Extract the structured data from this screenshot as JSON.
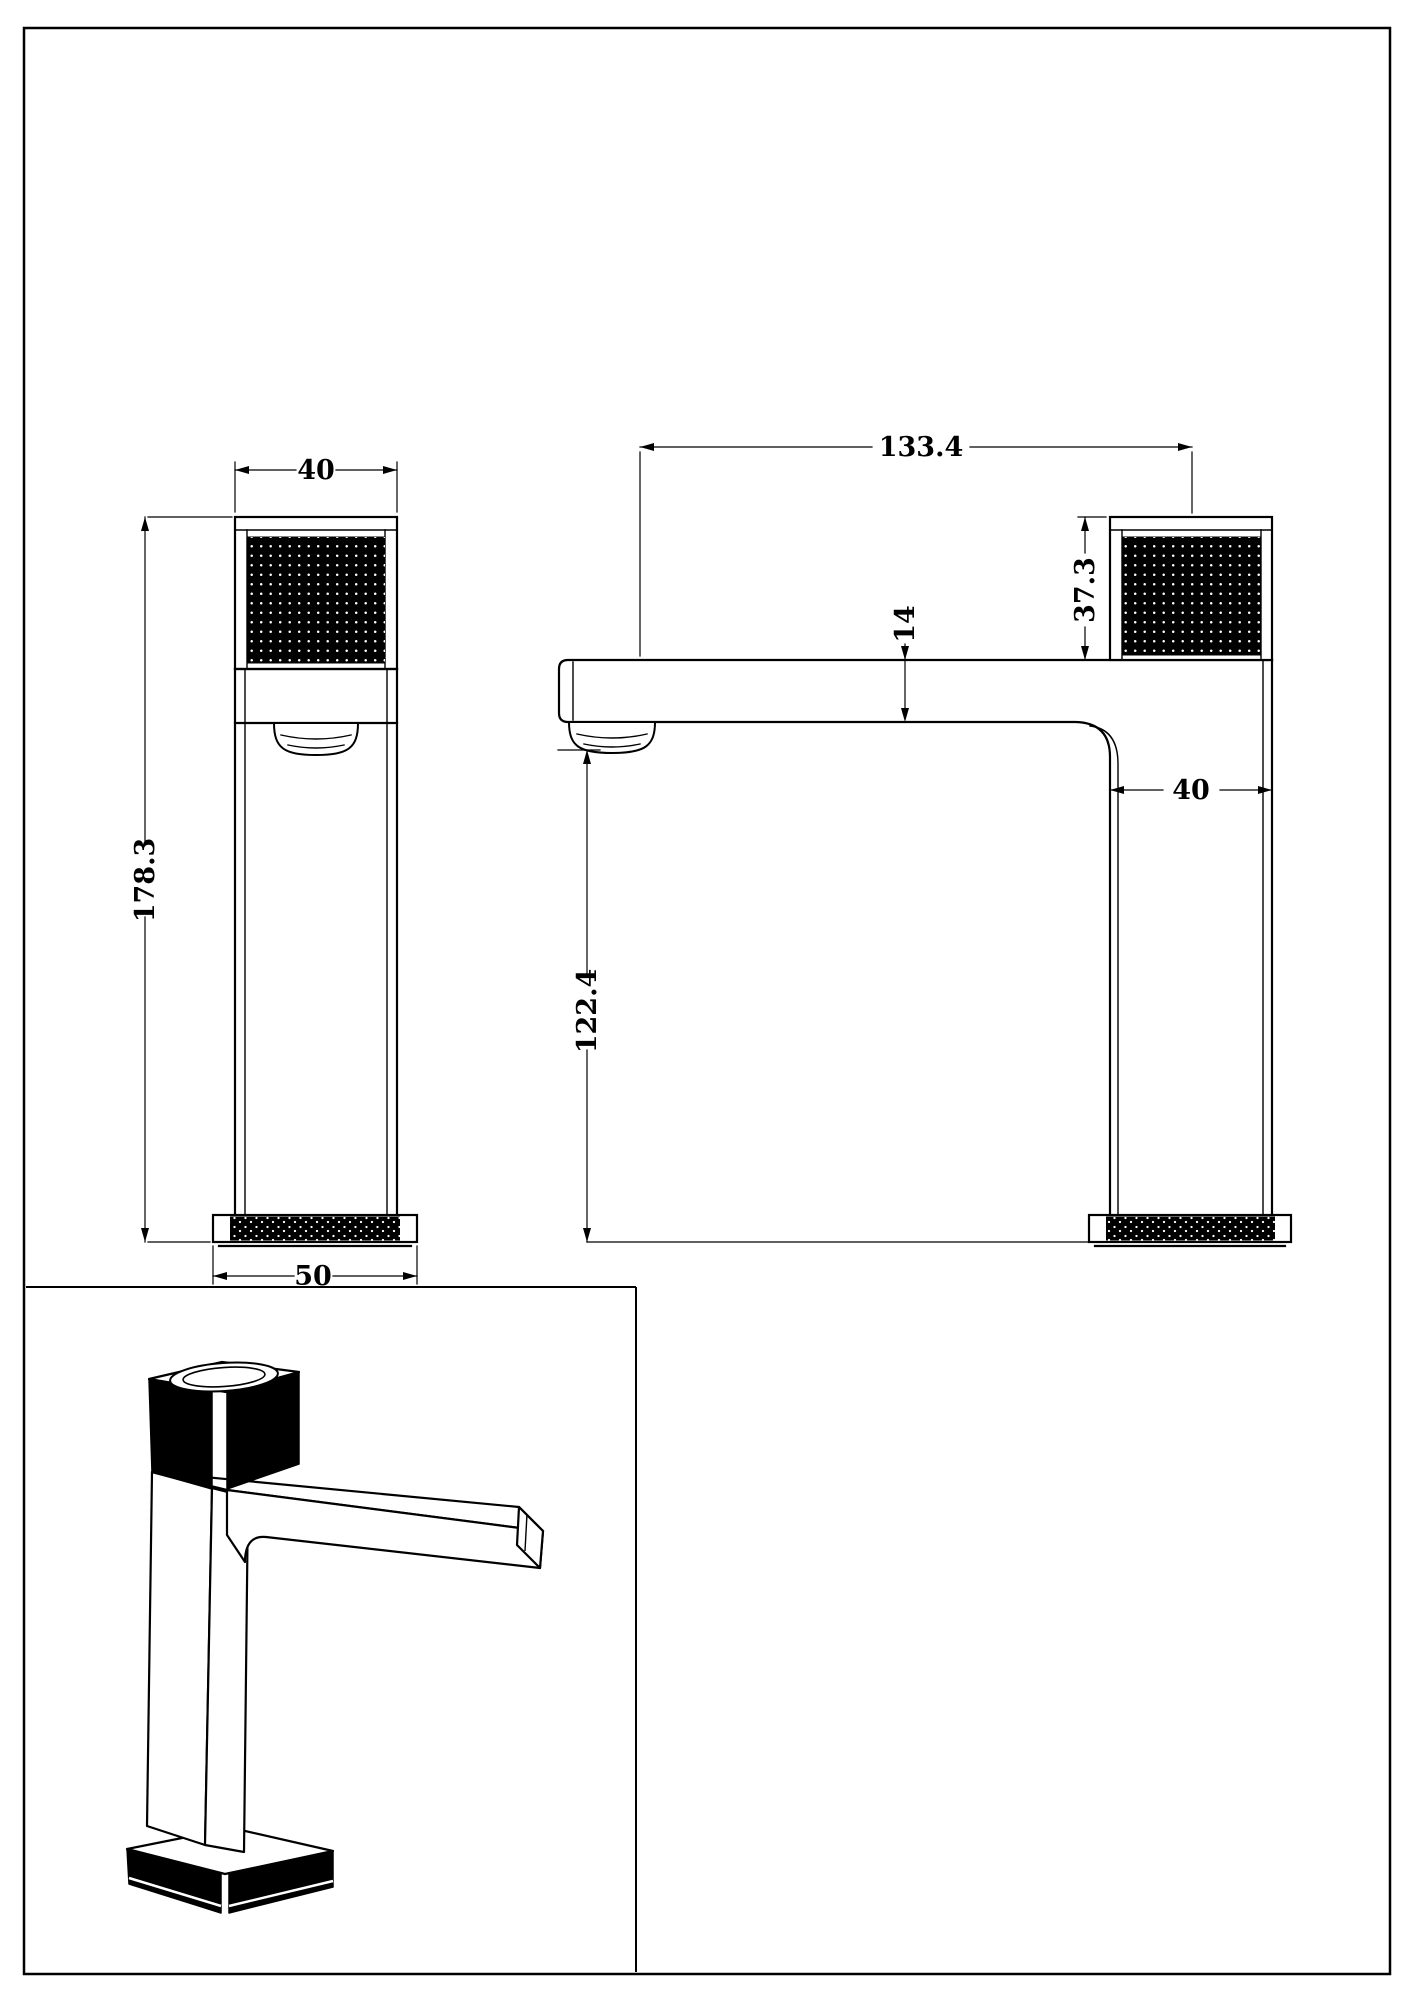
{
  "drawing": {
    "front_view": {
      "top_width": "40",
      "overall_height": "178.3",
      "base_width": "50"
    },
    "side_view": {
      "spout_reach": "133.4",
      "handle_height": "37.3",
      "spout_thickness": "14",
      "outlet_height": "122.4",
      "body_depth": "40"
    }
  },
  "colors": {
    "line": "#000000",
    "background": "#ffffff",
    "knurl_fill": "#000000",
    "knurl_dot": "#ffffff"
  }
}
